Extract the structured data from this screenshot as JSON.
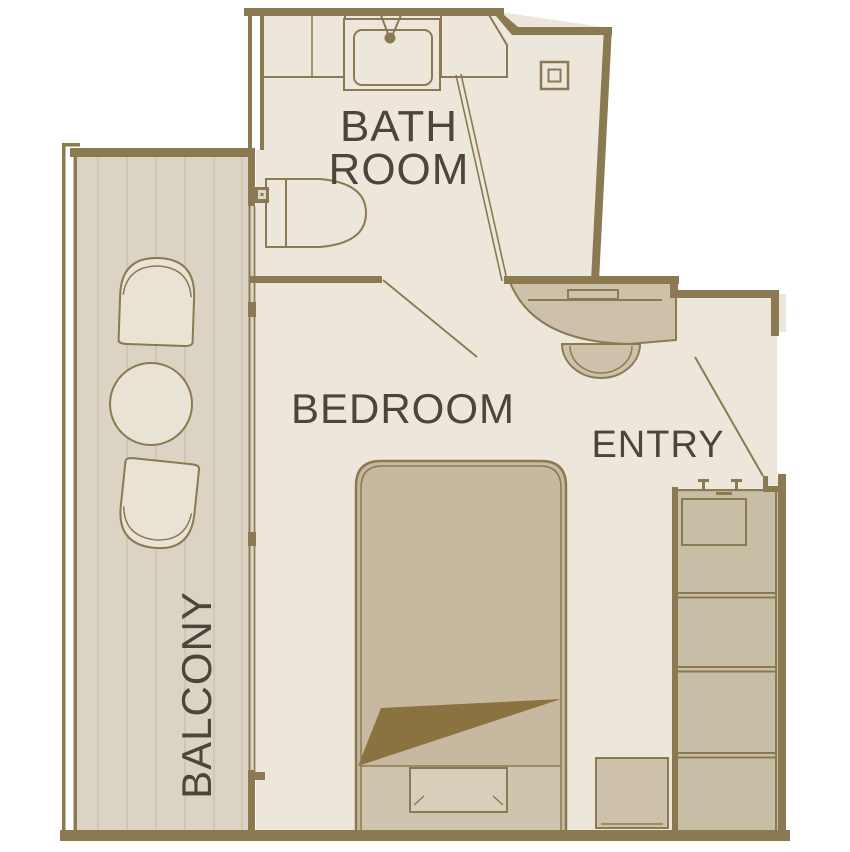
{
  "floorplan": {
    "labels": {
      "bathroom_line1": "BATH",
      "bathroom_line2": "ROOM",
      "bedroom": "BEDROOM",
      "entry": "ENTRY",
      "balcony": "BALCONY"
    },
    "colors": {
      "wall": "#8b7a51",
      "floor": "#ece7da",
      "deck": "#dbd3c3",
      "plank": "#cabfae",
      "tan": "#cdc1a9",
      "closet": "#c8bda5",
      "bed": "#c6b99f",
      "bed-foot": "#cfc5ae",
      "bench": "#d8cfbb",
      "blanket": "#8a7241",
      "chair": "#e8e3d5",
      "text": "#4b453b",
      "bg": "#ffffff"
    }
  }
}
